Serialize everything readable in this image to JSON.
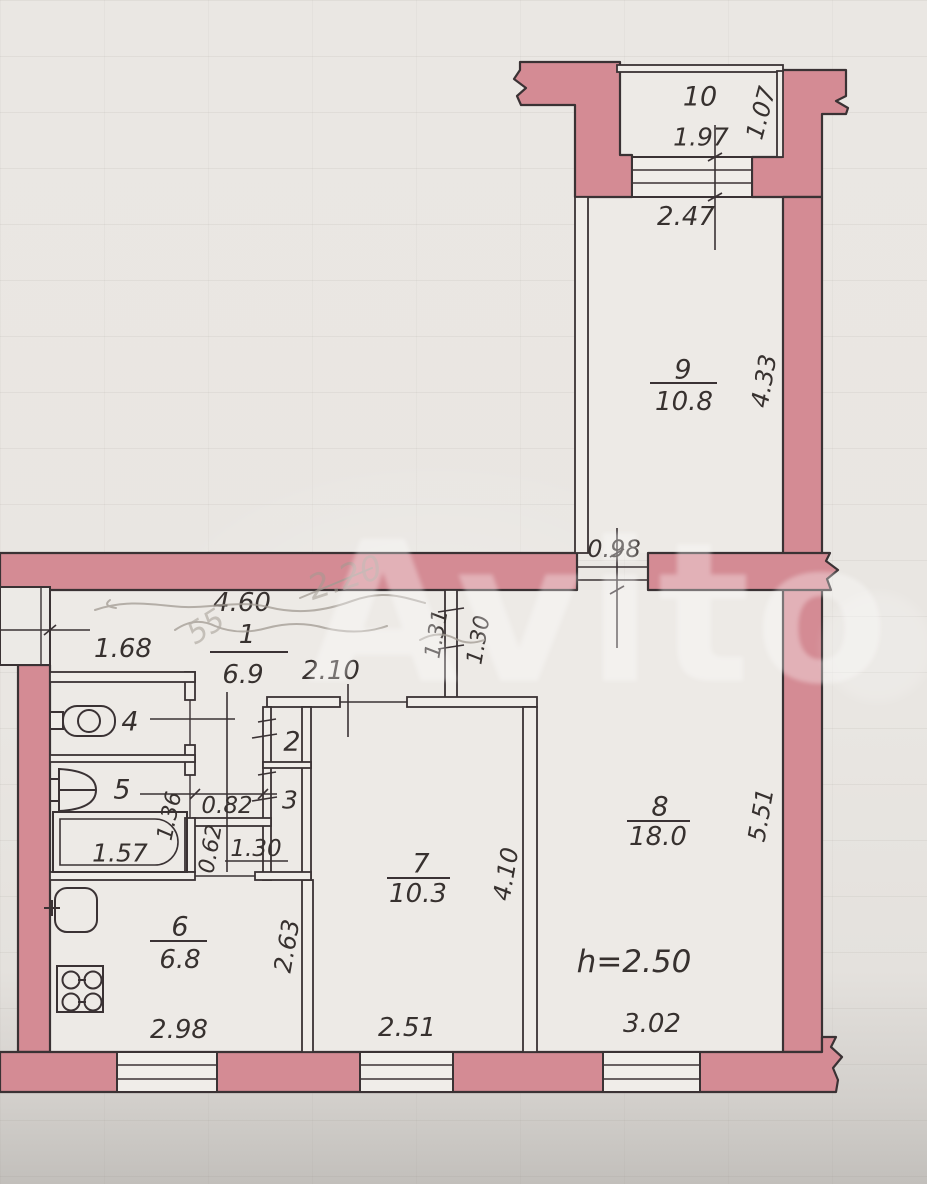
{
  "watermark": {
    "text": "Avito"
  },
  "pencil_notes": {
    "diagonal": "2.20",
    "left": "55"
  },
  "note": {
    "ceiling_height": "h=2.50"
  },
  "rooms": {
    "r1": {
      "number": "1",
      "area": "6.9"
    },
    "r2": {
      "number": "2"
    },
    "r3": {
      "number": "3"
    },
    "r4": {
      "number": "4"
    },
    "r5": {
      "number": "5"
    },
    "r6": {
      "number": "6",
      "area": "6.8"
    },
    "r7": {
      "number": "7",
      "area": "10.3"
    },
    "r8": {
      "number": "8",
      "area": "18.0"
    },
    "r9": {
      "number": "9",
      "area": "10.8"
    },
    "r10": {
      "number": "10"
    }
  },
  "dimensions": {
    "top_197": "1.97",
    "balcony_107": "1.07",
    "window_247": "2.47",
    "room9_433": "4.33",
    "door_098": "0.98",
    "hall_460": "4.60",
    "hall_168": "1.68",
    "door7_210": "2.10",
    "pass_131": "1.31",
    "pass_130": "1.30",
    "corr_082": "0.82",
    "bath_136": "1.36",
    "tub_157": "1.57",
    "corr_062": "0.62",
    "kdoor_130": "1.30",
    "kitchen_263": "2.63",
    "kwin_298": "2.98",
    "w7_251": "2.51",
    "w8_302": "3.02",
    "room7_410": "4.10",
    "room8_551": "5.51"
  },
  "colors": {
    "wall_fill": "#d48b94",
    "outline": "#3a3234",
    "paper": "#e9e6e2"
  }
}
